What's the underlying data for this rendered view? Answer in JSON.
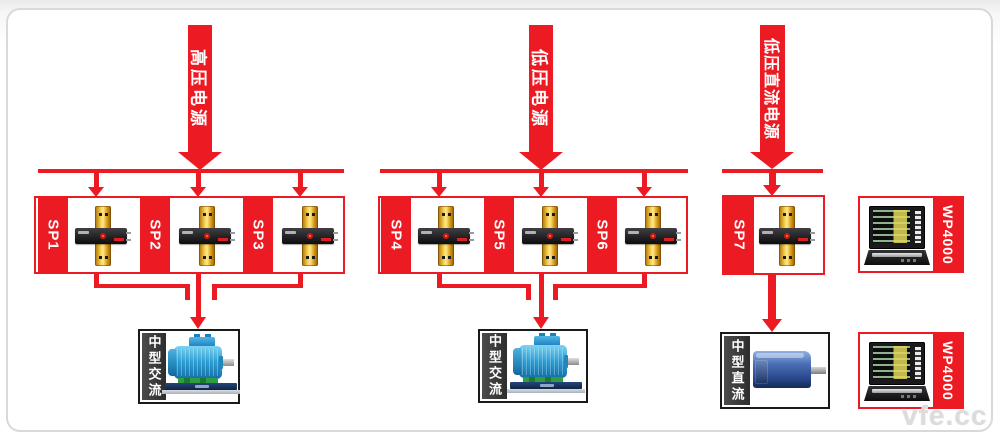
{
  "banners": {
    "high_voltage": "高压电源",
    "low_voltage": "低压电源",
    "low_voltage_dc": "低压直流电源"
  },
  "sensor_groups": [
    {
      "units": [
        "SP1",
        "SP2",
        "SP3"
      ]
    },
    {
      "units": [
        "SP4",
        "SP5",
        "SP6"
      ]
    },
    {
      "units": [
        "SP7"
      ]
    }
  ],
  "loads": [
    {
      "label": "中型交流"
    },
    {
      "label": "中型交流"
    },
    {
      "label": "中型直流"
    }
  ],
  "analyzers": [
    {
      "model": "WP4000"
    },
    {
      "model": "WP4000"
    }
  ],
  "watermark": "vfe.cc",
  "colors": {
    "accent_red": "#EC1B23",
    "panel_border": "#D9D9D9",
    "motor_label_bg": "#3A3A3A",
    "ac_motor_blue": "#2D9FD6",
    "dc_motor_blue": "#3F66AE",
    "sensor_gold": "#F0C14B"
  }
}
